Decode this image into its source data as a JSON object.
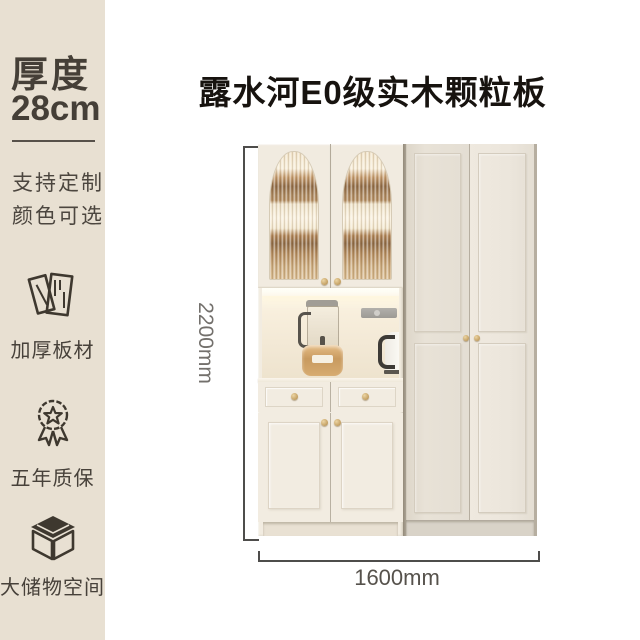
{
  "colors": {
    "sidebar_bg": "#e8e0d2",
    "sidebar_text": "#453f37",
    "title_text": "#17130f",
    "dim_line": "#4e4d4b",
    "dim_text_v": "#73706c",
    "dim_text_h": "#56524c",
    "gold_knob": "#c9a76b"
  },
  "sidebar": {
    "thickness_label": "厚度",
    "thickness_value": "28cm",
    "note_line1": "支持定制",
    "note_line2": "颜色可选",
    "features": [
      {
        "icon": "thick-board-icon",
        "label": "加厚板材"
      },
      {
        "icon": "warranty-medal-icon",
        "label": "五年质保"
      },
      {
        "icon": "storage-box-icon",
        "label": "大储物空间"
      }
    ]
  },
  "header": {
    "title": "露水河E0级实木颗粒板"
  },
  "dimensions": {
    "height": "2200mm",
    "width": "1600mm"
  }
}
